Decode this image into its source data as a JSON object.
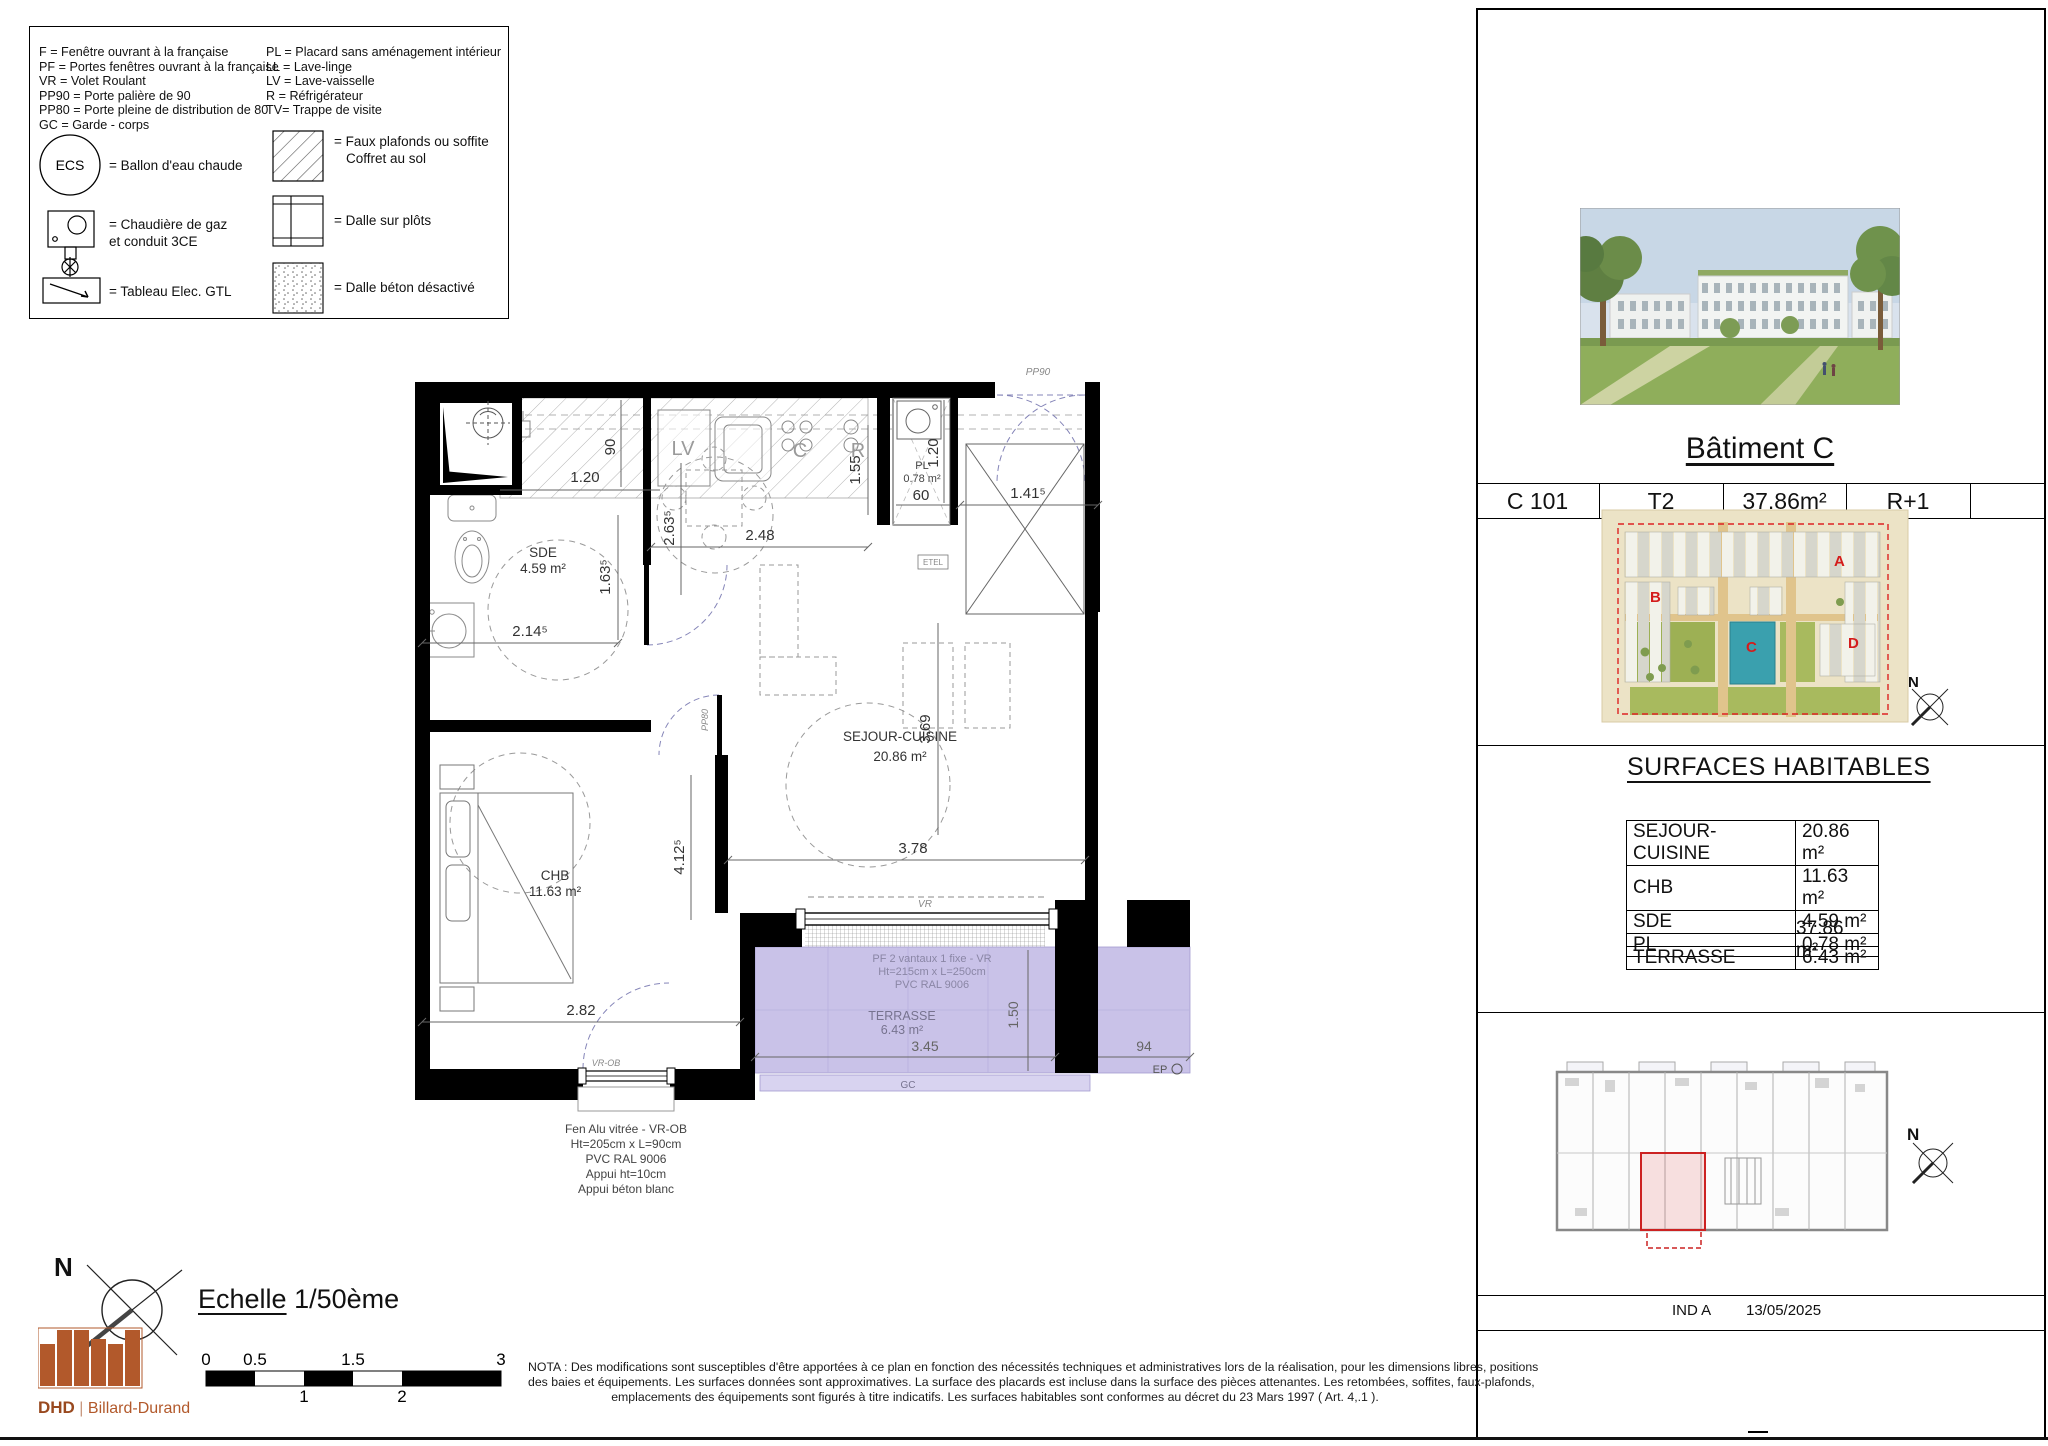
{
  "colors": {
    "terrace": "#c9c2e8",
    "terrace_rail": "#d8d3f0",
    "highlight_red": "#cc1a1a",
    "building_c_teal": "#3aa0ae",
    "logo_orange": "#b2592b",
    "door_dash_blue": "#8585b8"
  },
  "compass": {
    "n": "N"
  },
  "legend": {
    "col1": [
      "F = Fenêtre ouvrant à la française",
      "PF = Portes fenêtres ouvrant à la française",
      "VR = Volet Roulant",
      "PP90 = Porte palière de 90",
      "PP80 = Porte pleine de distribution de 80",
      "GC = Garde - corps"
    ],
    "col2": [
      "PL = Placard sans aménagement intérieur",
      "LL = Lave-linge",
      "LV = Lave-vaisselle",
      "R = Réfrigérateur",
      "TV= Trappe de visite"
    ],
    "ecs": "ECS",
    "labels": {
      "ballon": "= Ballon d'eau chaude",
      "boiler1": "= Chaudière de gaz",
      "boiler2": "et conduit 3CE",
      "elec": "= Tableau Elec. GTL",
      "hatch1": "= Faux plafonds ou soffite",
      "hatch2": "Coffret au sol",
      "plots": "= Dalle sur plôts",
      "stipple": "= Dalle béton désactivé"
    }
  },
  "plan": {
    "rooms": {
      "sde_name": "SDE",
      "sde_area": "4.59 m²",
      "chb_name": "CHB",
      "chb_area": "11.63 m²",
      "sejour_name": "SEJOUR-CUISINE",
      "sejour_area": "20.86 m²",
      "pl_name": "PL",
      "pl_area": "0.78 m²",
      "terrasse_name": "TERRASSE",
      "terrasse_area": "6.43 m²"
    },
    "appliances": {
      "lv": "LV",
      "c": "C",
      "r": "R"
    },
    "doors": {
      "pp90": "PP90",
      "pp80": "PP80",
      "etel": "ETEL"
    },
    "windows": {
      "vr": "VR",
      "vrob": "VR-OB",
      "gc": "GC",
      "ep": "EP"
    },
    "dims": {
      "k_120": "1.20",
      "k_90": "90",
      "s_248": "2.48",
      "s_2635": "2.63⁵",
      "c_155": "1.55",
      "sde_1635": "1.63⁵",
      "sde_2145": "2.14⁵",
      "pl_60": "60",
      "pl_120": "1.20",
      "e_1415": "1.41⁵",
      "chb_4125": "4.12⁵",
      "sj_378": "3.78",
      "sj_369": "3.69",
      "chb_282": "2.82",
      "t_345": "3.45",
      "t_150": "1.50",
      "t_94": "94"
    },
    "pf_note": [
      "PF 2 vantaux 1 fixe - VR",
      "Ht=215cm x L=250cm",
      "PVC RAL 9006"
    ],
    "fen_note": [
      "Fen Alu vitrée - VR-OB",
      "Ht=205cm x L=90cm",
      "PVC RAL 9006",
      "Appui ht=10cm",
      "Appui béton blanc"
    ]
  },
  "titleblock": {
    "title": "Bâtiment C",
    "unit": {
      "ref": "C 101",
      "type": "T2",
      "area": "37.86m²",
      "floor": "R+1"
    },
    "site": {
      "a": "A",
      "b": "B",
      "c": "C",
      "d": "D"
    },
    "surfaces_title": "SURFACES HABITABLES",
    "surfaces": [
      {
        "label": "SEJOUR-CUISINE",
        "value": "20.86 m²"
      },
      {
        "label": "CHB",
        "value": "11.63 m²"
      },
      {
        "label": "SDE",
        "value": "4.59 m²"
      },
      {
        "label": "PL",
        "value": "0.78 m²"
      }
    ],
    "total": "37.86 m²",
    "terrace": {
      "label": "TERRASSE",
      "value": "6.43 m²"
    },
    "index": "IND A",
    "date": "13/05/2025"
  },
  "footer": {
    "scale_label": "Echelle",
    "scale_value": "1/50ème",
    "scale_top": [
      "0",
      "0.5",
      "1.5",
      "3"
    ],
    "scale_bottom": [
      "1",
      "2"
    ],
    "nota": [
      "NOTA : Des modifications sont susceptibles d'être apportées à ce plan en fonction des nécessités techniques et administratives lors de la réalisation, pour les dimensions libres, positions",
      "des baies et équipements. Les surfaces données sont approximatives. La surface des placards est incluse dans la surface des pièces attenantes. Les retombées, soffites, faux-plafonds,",
      "emplacements des équipements sont figurés à titre indicatifs. Les surfaces habitables sont conformes au décret du 23 Mars 1997 ( Art. 4,.1 )."
    ],
    "logo": {
      "dhd": "DHD",
      "sep": "|",
      "name": "Billard-Durand"
    }
  }
}
